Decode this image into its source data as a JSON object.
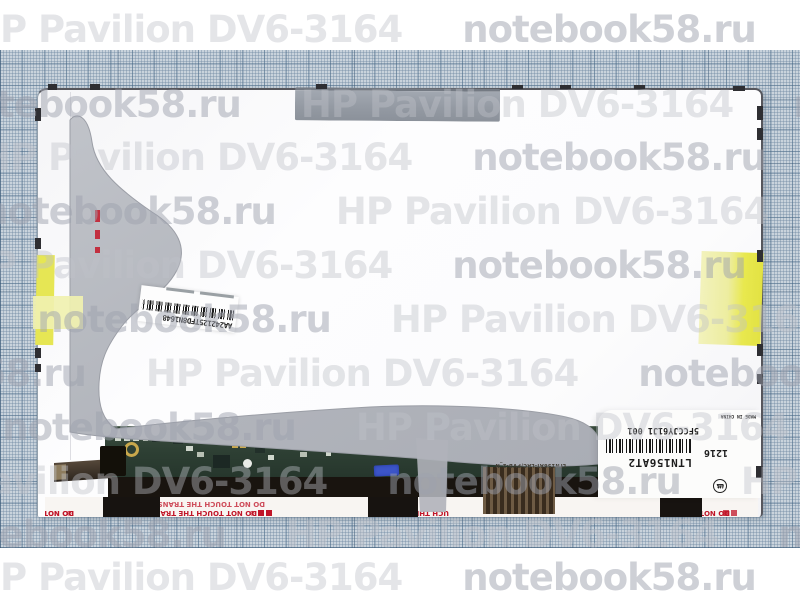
{
  "watermark": {
    "primary": "HP Pavilion DV6-3164",
    "secondary": "notebook58.ru"
  },
  "stickers": {
    "barcode_label": {
      "code": "AA242125TFD8N1648"
    },
    "panel_label": {
      "serial": "5FCCJY61J1 001",
      "model": "LTN156AT2",
      "week": "1216",
      "cert_c": "c",
      "cert_ul": "UL",
      "cert_us": "us",
      "origin": "MADE IN CHINA"
    }
  },
  "warning": {
    "full": "DO NOT TOUCH THE TRANSPARENT",
    "short": "DO NOT TOUCH THE",
    "frag_mid": "UCH THE TRA",
    "frag_right": "DO NOT TOUC",
    "mark": "⊛"
  },
  "pcb": {
    "silk": "LTN156AT-LAC/PVB-2_N"
  },
  "colors": {
    "paper": "#c9d3dc",
    "panel": "#fbfbfc",
    "film_gray": "#b4b7bd",
    "tape_gray": "#949aa3",
    "sticker_yellow": "#e6e654",
    "pcb_green": "#2e4034",
    "warning_red": "#c01528",
    "stamp_blue": "#3c55c8"
  }
}
